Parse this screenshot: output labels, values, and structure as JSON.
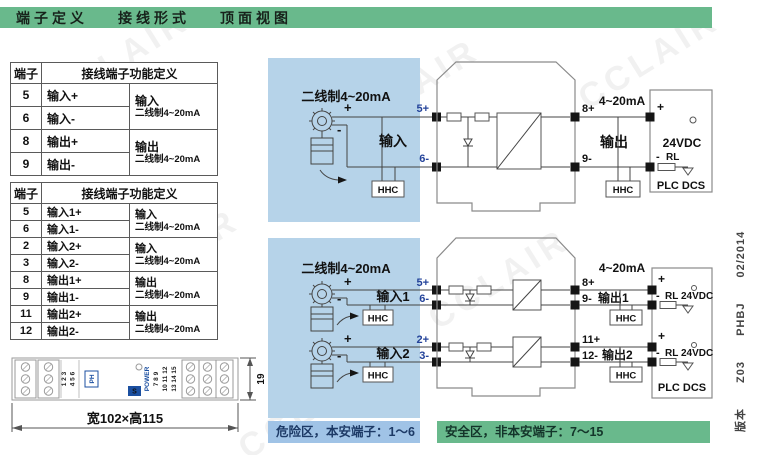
{
  "title_bar": {
    "items": [
      "端子定义",
      "接线形式",
      "顶面视图"
    ]
  },
  "watermark": "CCLAIR",
  "table_header": {
    "terminal": "端子",
    "function": "接线端子功能定义"
  },
  "table1": {
    "rows": [
      {
        "no": "5",
        "label": "输入+"
      },
      {
        "no": "6",
        "label": "输入-"
      },
      {
        "no": "8",
        "label": "输出+"
      },
      {
        "no": "9",
        "label": "输出-"
      }
    ],
    "groups": [
      {
        "title": "输入",
        "desc": "二线制4~20mA"
      },
      {
        "title": "输出",
        "desc": "二线制4~20mA"
      }
    ]
  },
  "table2": {
    "rows": [
      {
        "no": "5",
        "label": "输入1+"
      },
      {
        "no": "6",
        "label": "输入1-"
      },
      {
        "no": "2",
        "label": "输入2+"
      },
      {
        "no": "3",
        "label": "输入2-"
      },
      {
        "no": "8",
        "label": "输出1+"
      },
      {
        "no": "9",
        "label": "输出1-"
      },
      {
        "no": "11",
        "label": "输出2+"
      },
      {
        "no": "12",
        "label": "输出2-"
      }
    ],
    "groups": [
      {
        "title": "输入",
        "desc": "二线制4~20mA"
      },
      {
        "title": "输入",
        "desc": "二线制4~20mA"
      },
      {
        "title": "输出",
        "desc": "二线制4~20mA"
      },
      {
        "title": "输出",
        "desc": "二线制4~20mA"
      }
    ]
  },
  "diagram1": {
    "source_label": "二线制4~20mA",
    "plus": "+",
    "minus": "-",
    "input": "输入",
    "output": "输出",
    "hhc": "HHC",
    "t5": "5+",
    "t6": "6-",
    "t8": "8+",
    "t9": "9-",
    "current": "4~20mA",
    "rl": "RL",
    "vdc": "24VDC",
    "plc": "PLC DCS"
  },
  "diagram2": {
    "source_label": "二线制4~20mA",
    "plus": "+",
    "minus": "-",
    "input1": "输入1",
    "input2": "输入2",
    "output1": "输出1",
    "output2": "输出2",
    "hhc": "HHC",
    "t5": "5+",
    "t6": "6-",
    "t2": "2+",
    "t3": "3-",
    "t8": "8+",
    "t9": "9-",
    "t11": "11+",
    "t12": "12-",
    "current": "4~20mA",
    "rl": "RL",
    "vdc": "24VDC",
    "plc": "PLC DCS"
  },
  "zones": {
    "hazard": "危险区，本安端子：1～6",
    "safe": "安全区，非本安端子：7～15"
  },
  "device": {
    "power": "POWER",
    "logo_left": "PH",
    "logo_right": "S",
    "left_col1": "1 2 3",
    "left_col2": "4 5 6",
    "right_col1": "7 8 9",
    "right_col2": "10 11 12",
    "right_col3": "13 14 15",
    "dim_width": "宽102×高115",
    "dim_height": "19"
  },
  "side_note": {
    "parts": [
      "版本",
      "Z03",
      "PHBJ",
      "02/2014"
    ]
  },
  "colors": {
    "header_green": "#69b98c",
    "hazard_region_blue": "#b6d3e9",
    "hazard_bar_blue": "#a0c3e6",
    "safe_bar_green": "#69b98c",
    "terminal_number_blue": "#2b5fc0",
    "logo_blue": "#1b4fa0"
  }
}
